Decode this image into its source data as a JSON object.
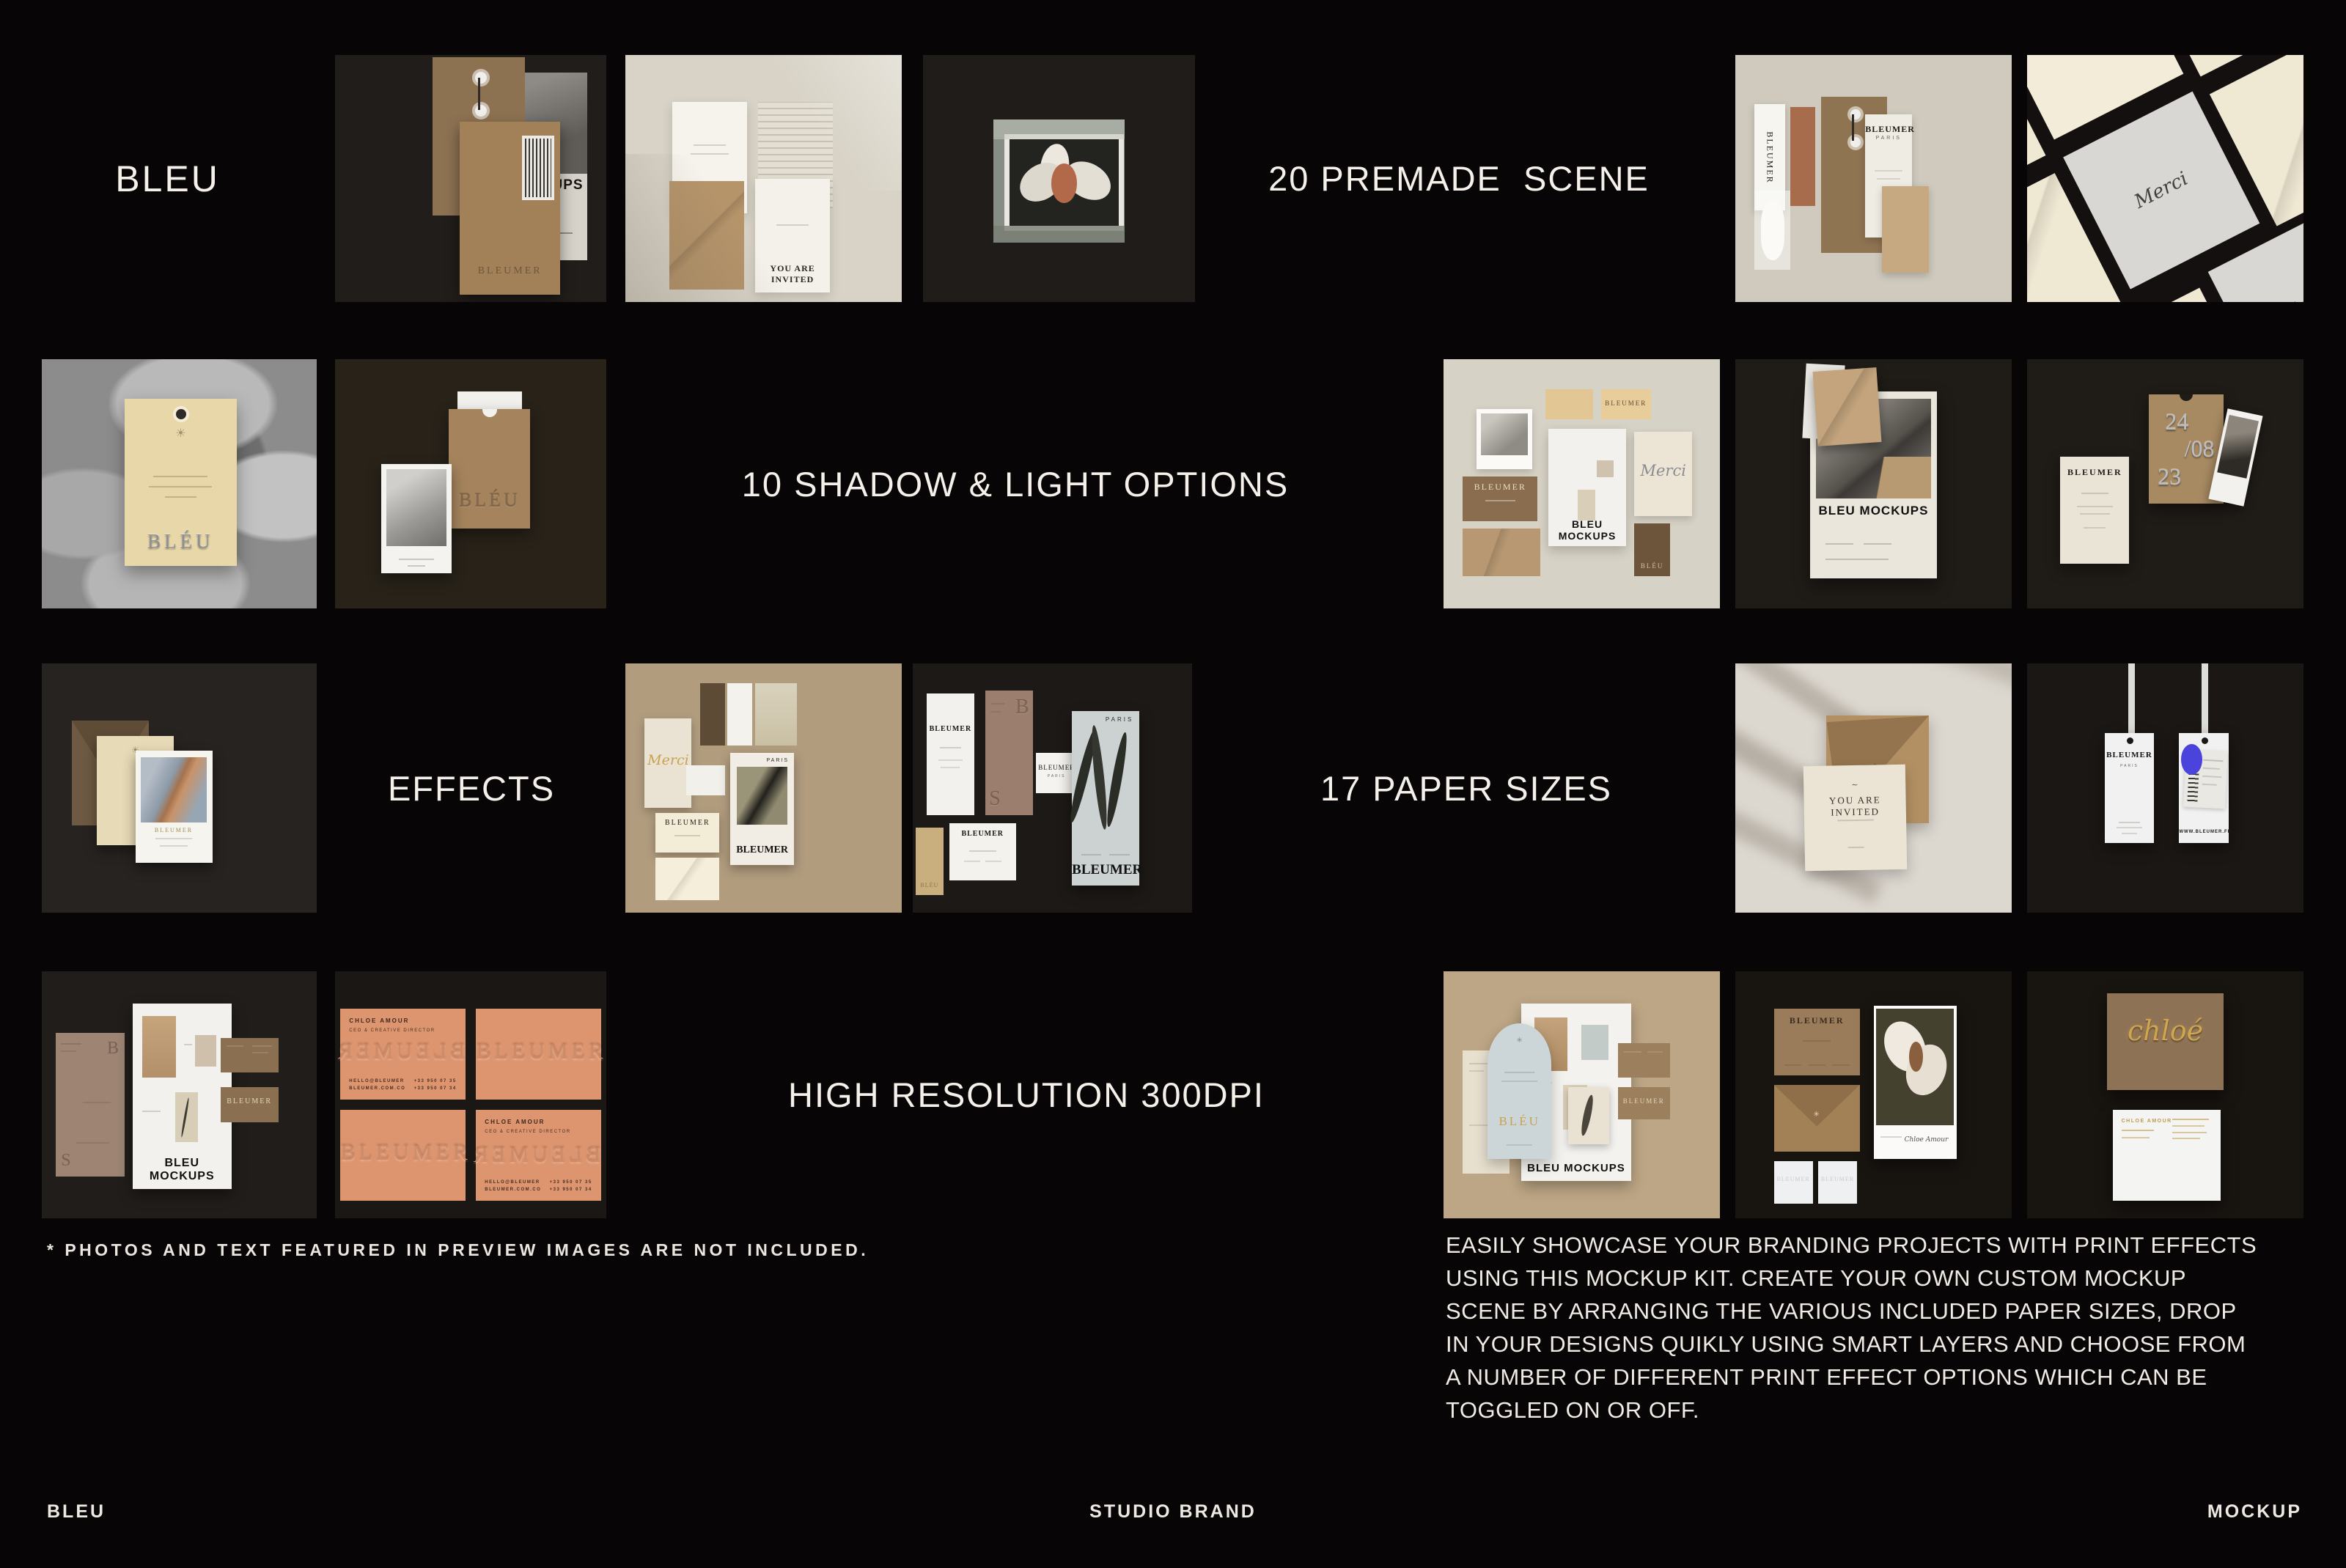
{
  "header": {
    "brand": "BLEU",
    "premade_label": "20 PREMADE  SCENE"
  },
  "section_labels": {
    "shadow_light": "10 SHADOW & LIGHT OPTIONS",
    "effects": "EFFECTS",
    "paper_sizes": "17 PAPER SIZES",
    "resolution": "HIGH RESOLUTION 300DPI"
  },
  "disclaimer": "* PHOTOS AND TEXT FEATURED IN PREVIEW IMAGES ARE NOT INCLUDED.",
  "description": "EASILY SHOWCASE YOUR BRANDING PROJECTS WITH PRINT EFFECTS\nUSING THIS MOCKUP KIT. CREATE YOUR OWN CUSTOM MOCKUP\nSCENE BY ARRANGING THE VARIOUS INCLUDED PAPER SIZES, DROP\nIN YOUR DESIGNS QUIKLY USING SMART LAYERS AND CHOOSE FROM\nA NUMBER OF DIFFERENT PRINT EFFECT OPTIONS WHICH CAN BE\nTOGGLED ON OR OFF.",
  "footer": {
    "left": "BLEU",
    "center": "STUDIO BRAND",
    "right": "MOCKUP"
  },
  "mockup_text": {
    "bleumer": "BLEUMER",
    "paris": "PARIS",
    "mockups": "MOCKUPS",
    "bleu_mockups": "BLEU MOCKUPS",
    "merci": "Merci",
    "bleu": "BLÉU",
    "you_are_invited": "YOU ARE INVITED",
    "date_day": "24",
    "date_month": "/08",
    "date_year": "23",
    "chloe_amour": "CHLOE AMOUR",
    "ceo_title": "CEO & CREATIVE DIRECTOR",
    "contact_left": "HELLO@BLEUMER\nBLEUMER.COM.CO",
    "contact_right": "+33 950 07 35\n+33 950 07 34",
    "chloe_script": "chloé",
    "website": "WWW.BLEUMER.FR",
    "sun_icon": "☀"
  },
  "colors": {
    "page_bg": "#070505",
    "tile_dark": "#211d1a",
    "tile_light_beige": "#d8d3c6",
    "tile_tan": "#b19c7e",
    "kraft": "#a3825c",
    "cream": "#e9e2d2",
    "terracotta": "#dd9570",
    "blue_sticker": "#4a43dc",
    "gold_foil": "#c9a24f",
    "silver_foil": "#b9bdc4",
    "heading_text": "#f5f0ea"
  }
}
